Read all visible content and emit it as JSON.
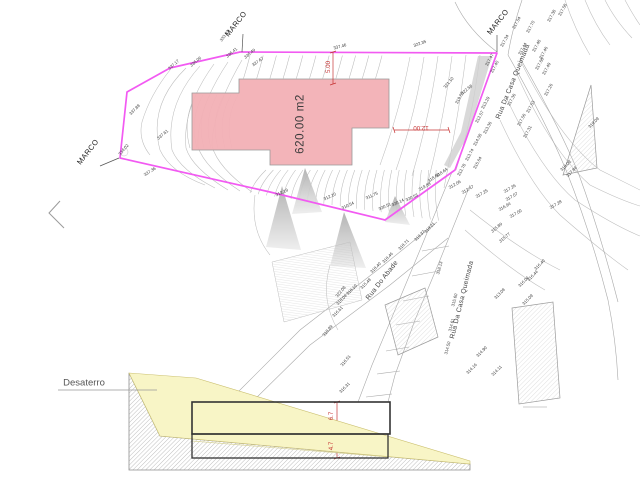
{
  "drawing": {
    "area_label": "620.00 m2",
    "section_label": "Desaterro",
    "dimensions": {
      "top_setback": "5.00",
      "side_setback": "12.00",
      "cut_height_upper": "6.7",
      "cut_height_lower": "4.7"
    },
    "survey_marker_label": "MARCO",
    "streets": [
      "Rua Do Abade",
      "Rua Da Casa Queimada"
    ]
  },
  "colors": {
    "lot_boundary": "#f25af2",
    "building_fill": "#f2b0b5",
    "dimension_red": "#c63434",
    "terrain_yellow": "#f8f5c6",
    "contour_gray": "#bdbdbd",
    "label_gray": "#3a3a3a"
  },
  "labels": [
    [
      "MARCO",
      236,
      24,
      -52,
      "m"
    ],
    [
      "MARCO",
      88,
      152,
      -52,
      "m"
    ],
    [
      "MARCO",
      498,
      22,
      -52,
      "m"
    ],
    [
      "Rua Do Abade",
      383,
      281,
      -52,
      "s"
    ],
    [
      "Rua Da Casa Queimada",
      514,
      82,
      -68,
      "s"
    ],
    [
      "Rua Da Casa Queimada",
      463,
      300,
      -76,
      "s"
    ],
    [
      "5.00",
      329,
      67,
      -90,
      "d"
    ],
    [
      "12.00",
      421,
      127,
      180,
      "d"
    ],
    [
      "6.7",
      332,
      416,
      -90,
      "d"
    ],
    [
      "4.7",
      332,
      446,
      -90,
      "d"
    ],
    [
      "620.00 m2",
      301,
      124,
      -90,
      "a"
    ],
    [
      "Desaterro",
      84,
      383,
      0,
      "t"
    ],
    [
      "333.23",
      225,
      36,
      -55,
      "e"
    ],
    [
      "336.06",
      196,
      62,
      -40,
      "e"
    ],
    [
      "336.41",
      232,
      53,
      -40,
      "e"
    ],
    [
      "336.49",
      250,
      54,
      -40,
      "e"
    ],
    [
      "337.17",
      174,
      65,
      -42,
      "e"
    ],
    [
      "337.46",
      340,
      47,
      -15,
      "e"
    ],
    [
      "322.35",
      420,
      44,
      -20,
      "e"
    ],
    [
      "337.88",
      135,
      110,
      -45,
      "e"
    ],
    [
      "337.61",
      163,
      135,
      -40,
      "e"
    ],
    [
      "337.36",
      150,
      172,
      -32,
      "e"
    ],
    [
      "334.02",
      124,
      150,
      -50,
      "e"
    ],
    [
      "337.67",
      258,
      62,
      -35,
      "e"
    ],
    [
      "317.54",
      517,
      23,
      -62,
      "e"
    ],
    [
      "317.70",
      531,
      27,
      -62,
      "e"
    ],
    [
      "317.38",
      552,
      16,
      -62,
      "e"
    ],
    [
      "317.58",
      563,
      10,
      -62,
      "e"
    ],
    [
      "317.34",
      505,
      41,
      -62,
      "e"
    ],
    [
      "317.44",
      523,
      49,
      -62,
      "e"
    ],
    [
      "317.48",
      537,
      46,
      -62,
      "e"
    ],
    [
      "317.46",
      544,
      53,
      -62,
      "e"
    ],
    [
      "317.68",
      540,
      64,
      -62,
      "e"
    ],
    [
      "317.49",
      547,
      69,
      -62,
      "e"
    ],
    [
      "317.47",
      490,
      60,
      -62,
      "e"
    ],
    [
      "317.40",
      495,
      67,
      -62,
      "e"
    ],
    [
      "317.36",
      512,
      100,
      -62,
      "e"
    ],
    [
      "317.26",
      549,
      90,
      -62,
      "e"
    ],
    [
      "317.53",
      531,
      107,
      -62,
      "e"
    ],
    [
      "317.56",
      522,
      120,
      -62,
      "e"
    ],
    [
      "317.31",
      528,
      132,
      -62,
      "e"
    ],
    [
      "322.58",
      467,
      90,
      -40,
      "e"
    ],
    [
      "321.10",
      449,
      83,
      -50,
      "e"
    ],
    [
      "319.56",
      460,
      98,
      -62,
      "e"
    ],
    [
      "313.29",
      486,
      103,
      -62,
      "e"
    ],
    [
      "312.57",
      480,
      117,
      -62,
      "e"
    ],
    [
      "313.36",
      488,
      128,
      -62,
      "e"
    ],
    [
      "314.08",
      478,
      140,
      -62,
      "e"
    ],
    [
      "313.74",
      470,
      155,
      -62,
      "e"
    ],
    [
      "315.64",
      478,
      163,
      -62,
      "e"
    ],
    [
      "312.78",
      462,
      170,
      -62,
      "e"
    ],
    [
      "312.06",
      455,
      185,
      -30,
      "e"
    ],
    [
      "312.47",
      468,
      190,
      -30,
      "e"
    ],
    [
      "317.25",
      482,
      194,
      -30,
      "e"
    ],
    [
      "317.26",
      510,
      189,
      -30,
      "e"
    ],
    [
      "317.07",
      512,
      197,
      -30,
      "e"
    ],
    [
      "316.94",
      505,
      207,
      -30,
      "e"
    ],
    [
      "317.00",
      516,
      214,
      -30,
      "e"
    ],
    [
      "315.89",
      497,
      228,
      -40,
      "e"
    ],
    [
      "315.77",
      505,
      238,
      -40,
      "e"
    ],
    [
      "317.28",
      556,
      205,
      -30,
      "e"
    ],
    [
      "311.75",
      372,
      196,
      -25,
      "e"
    ],
    [
      "320.14",
      398,
      203,
      -25,
      "e"
    ],
    [
      "320.51",
      385,
      207,
      -25,
      "e"
    ],
    [
      "310.54",
      348,
      206,
      -25,
      "e"
    ],
    [
      "312.10",
      330,
      197,
      -25,
      "e"
    ],
    [
      "320.53",
      412,
      198,
      -25,
      "e"
    ],
    [
      "319.88",
      425,
      187,
      -30,
      "e"
    ],
    [
      "318.60",
      434,
      178,
      -35,
      "e"
    ],
    [
      "318.64",
      442,
      173,
      -35,
      "e"
    ],
    [
      "312.19",
      282,
      193,
      -25,
      "e"
    ],
    [
      "318.71",
      404,
      245,
      -45,
      "e"
    ],
    [
      "318.46",
      388,
      258,
      -45,
      "e"
    ],
    [
      "318.40",
      376,
      268,
      -45,
      "e"
    ],
    [
      "319.37",
      420,
      236,
      -45,
      "e"
    ],
    [
      "319.21",
      430,
      228,
      -45,
      "e"
    ],
    [
      "318.10",
      352,
      290,
      -45,
      "e"
    ],
    [
      "318.04",
      342,
      300,
      -45,
      "e"
    ],
    [
      "316.61",
      338,
      312,
      -45,
      "e"
    ],
    [
      "322.08",
      341,
      292,
      -50,
      "e"
    ],
    [
      "318.89",
      328,
      331,
      -50,
      "e"
    ],
    [
      "316.51",
      346,
      361,
      -50,
      "e"
    ],
    [
      "316.31",
      345,
      388,
      -45,
      "e"
    ],
    [
      "318.13",
      440,
      268,
      -75,
      "e"
    ],
    [
      "315.60",
      455,
      300,
      -75,
      "e"
    ],
    [
      "315.48",
      366,
      284,
      -45,
      "e"
    ],
    [
      "314.61",
      452,
      325,
      -75,
      "e"
    ],
    [
      "314.50",
      448,
      348,
      -75,
      "e"
    ],
    [
      "314.90",
      482,
      352,
      -45,
      "e"
    ],
    [
      "314.16",
      472,
      369,
      -45,
      "e"
    ],
    [
      "314.11",
      497,
      371,
      -45,
      "e"
    ],
    [
      "316.40",
      540,
      265,
      -45,
      "e"
    ],
    [
      "316.44",
      533,
      276,
      -45,
      "e"
    ],
    [
      "316.04",
      524,
      282,
      -45,
      "e"
    ],
    [
      "313.08",
      500,
      294,
      -45,
      "e"
    ],
    [
      "315.09",
      528,
      300,
      -45,
      "e"
    ],
    [
      "319.09",
      594,
      123,
      -45,
      "e"
    ],
    [
      "318.09",
      566,
      166,
      -45,
      "e"
    ],
    [
      "317.84",
      572,
      172,
      -45,
      "e"
    ]
  ]
}
